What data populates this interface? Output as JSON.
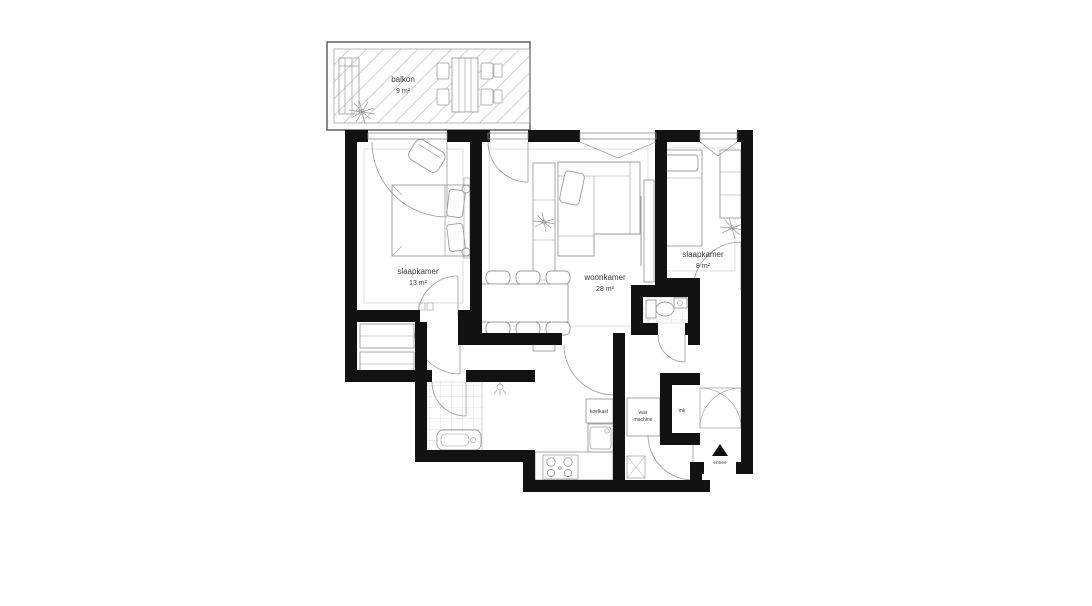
{
  "floorplan": {
    "kind": "apartment-floor-plan",
    "language": "nl",
    "rooms": [
      {
        "id": "balcony",
        "name": "balkon",
        "area": "9 m²"
      },
      {
        "id": "bedroom-1",
        "name": "slaapkamer",
        "area": "13 m²"
      },
      {
        "id": "living-room",
        "name": "woonkamer",
        "area": "28 m²"
      },
      {
        "id": "bedroom-2",
        "name": "slaapkamer",
        "area": "8 m²"
      }
    ],
    "appliances": {
      "fridge": "koelkast",
      "washer_line1": "was",
      "washer_line2": "machine",
      "meter_cupboard": "mk"
    },
    "entrance_label": "entree",
    "colors": {
      "wall": "#121212",
      "furniture_stroke": "#9b9b9b",
      "room_inset_stroke": "#d7d7d7",
      "tile_stroke": "#cccccc",
      "hatch_stroke": "#bcbcbc",
      "text": "#3a3a3a",
      "background": "#ffffff"
    }
  }
}
